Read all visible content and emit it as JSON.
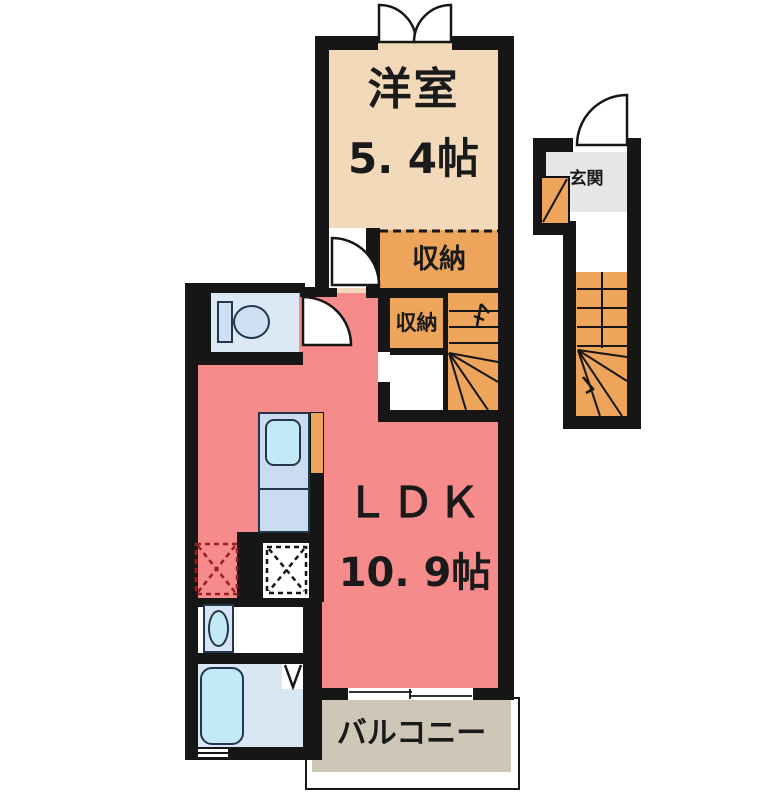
{
  "plan_title": "1LDK apartment floor plan",
  "rooms": {
    "western_room": {
      "name": "洋室",
      "size": "5. 4帖"
    },
    "closet_upper": {
      "label": "収納"
    },
    "closet_lower": {
      "label": "収納"
    },
    "ldk": {
      "name": "ＬＤＫ",
      "size": "10. 9帖"
    },
    "balcony": {
      "label": "バルコニー"
    },
    "entrance": {
      "label": "玄関"
    }
  },
  "fixtures": {
    "toilet": "toilet",
    "kitchen_sink": "kitchen-sink",
    "bathtub": "bathtub",
    "washbasin": "washbasin",
    "interior_staircase": "staircase-up",
    "entrance_staircase": "staircase-up",
    "shoe_cabinet": "shoe-cabinet",
    "washing_machine_space": "dashed-square",
    "refrigerator_space": "dashed-square"
  },
  "colors": {
    "walls": "#161616",
    "text": "#1a1a1a",
    "western_room": "#f2d9ba",
    "closet": "#eda45b",
    "ldk": "#f68b8b",
    "balcony": "#cec7b8",
    "entrance": "#e6e6e6",
    "toilet_floor": "#dce9f5",
    "bath_floor": "#d9e7f5",
    "cabinet_blue": "#cbdcf1",
    "water_fixture": "#c3e9f6",
    "fixture_outline": "#22364e",
    "dashed_red": "#9b1d1d"
  }
}
